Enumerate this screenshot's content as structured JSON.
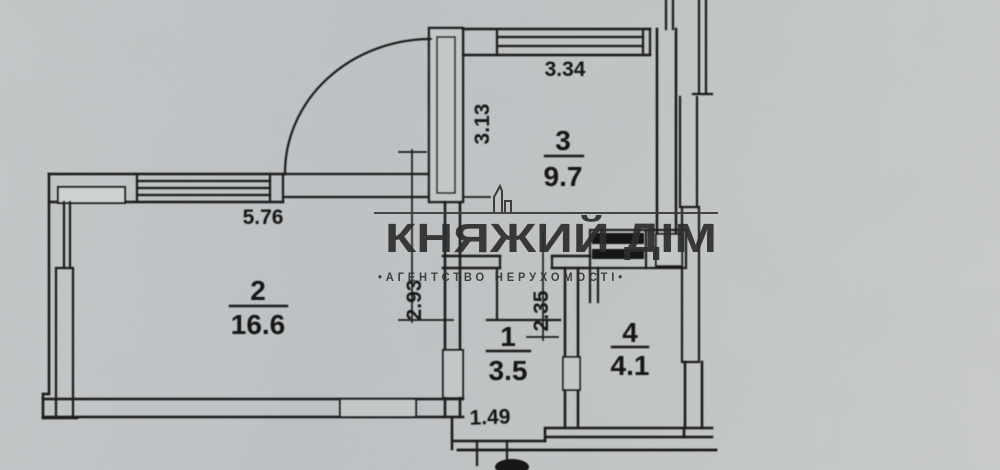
{
  "watermark": {
    "title": "КНЯЖИЙ ДІМ",
    "subtitle": "•АГЕНТСТВО НЕРУХОМОСТІ•"
  },
  "rooms": [
    {
      "number": "1",
      "area": "3.5"
    },
    {
      "number": "2",
      "area": "16.6"
    },
    {
      "number": "3",
      "area": "9.7"
    },
    {
      "number": "4",
      "area": "4.1"
    }
  ],
  "dimensions": {
    "room2_width": "5.76",
    "room3_width": "3.34",
    "room3_depth": "3.13",
    "corridor_depth": "2.93",
    "hall_depth": "2.35",
    "hall_width": "1.49"
  },
  "colors": {
    "paper": "#c4c7c8",
    "ink": "#1d1d1d",
    "watermark": "#2d2d2d"
  }
}
